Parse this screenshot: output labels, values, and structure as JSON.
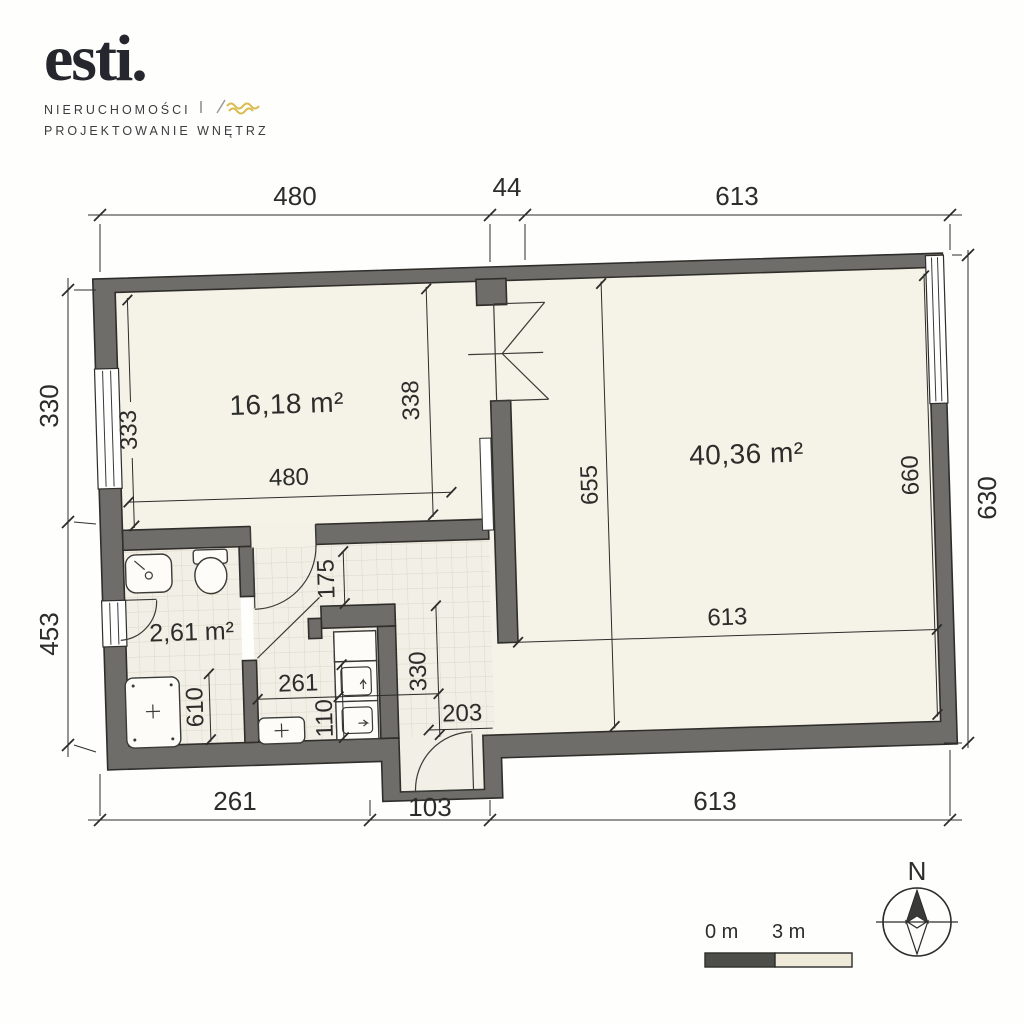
{
  "logo": {
    "brand": "esti.",
    "tagline_line1": "NIERUCHOMOŚCI",
    "tagline_line2": "PROJEKTOWANIE WNĘTRZ",
    "accent_color": "#dcbb4d"
  },
  "plan": {
    "rooms": [
      {
        "name": "small-room",
        "area": "16,18 m²"
      },
      {
        "name": "large-room",
        "area": "40,36 m²"
      },
      {
        "name": "bathroom",
        "area": "2,61 m²"
      }
    ],
    "exterior_dimensions": {
      "top": [
        "480",
        "44",
        "613"
      ],
      "left": [
        "330",
        "453"
      ],
      "right": [
        "630"
      ],
      "bottom": [
        "261",
        "103",
        "613"
      ]
    },
    "interior_dimensions": {
      "room_small_left": "333",
      "room_small_bottom": "480",
      "room_small_right": "338",
      "room_large_left": "655",
      "room_large_right": "660",
      "room_large_bottom": "613",
      "hall_width": "261",
      "bath_recess": "610",
      "entry_niche": "175",
      "kitchen_run": "110",
      "corridor": "330",
      "entry_clearance": "203"
    }
  },
  "scale_bar": {
    "start_label": "0 m",
    "end_label": "3 m"
  },
  "compass": {
    "north_label": "N"
  },
  "colors": {
    "wall": "#6e6d69",
    "floor": "#f5f2e8",
    "tile_line": "#dcd7c8",
    "ink": "#2c2c2a",
    "scale_dark": "#4d4d49",
    "scale_light": "#efe9da"
  }
}
